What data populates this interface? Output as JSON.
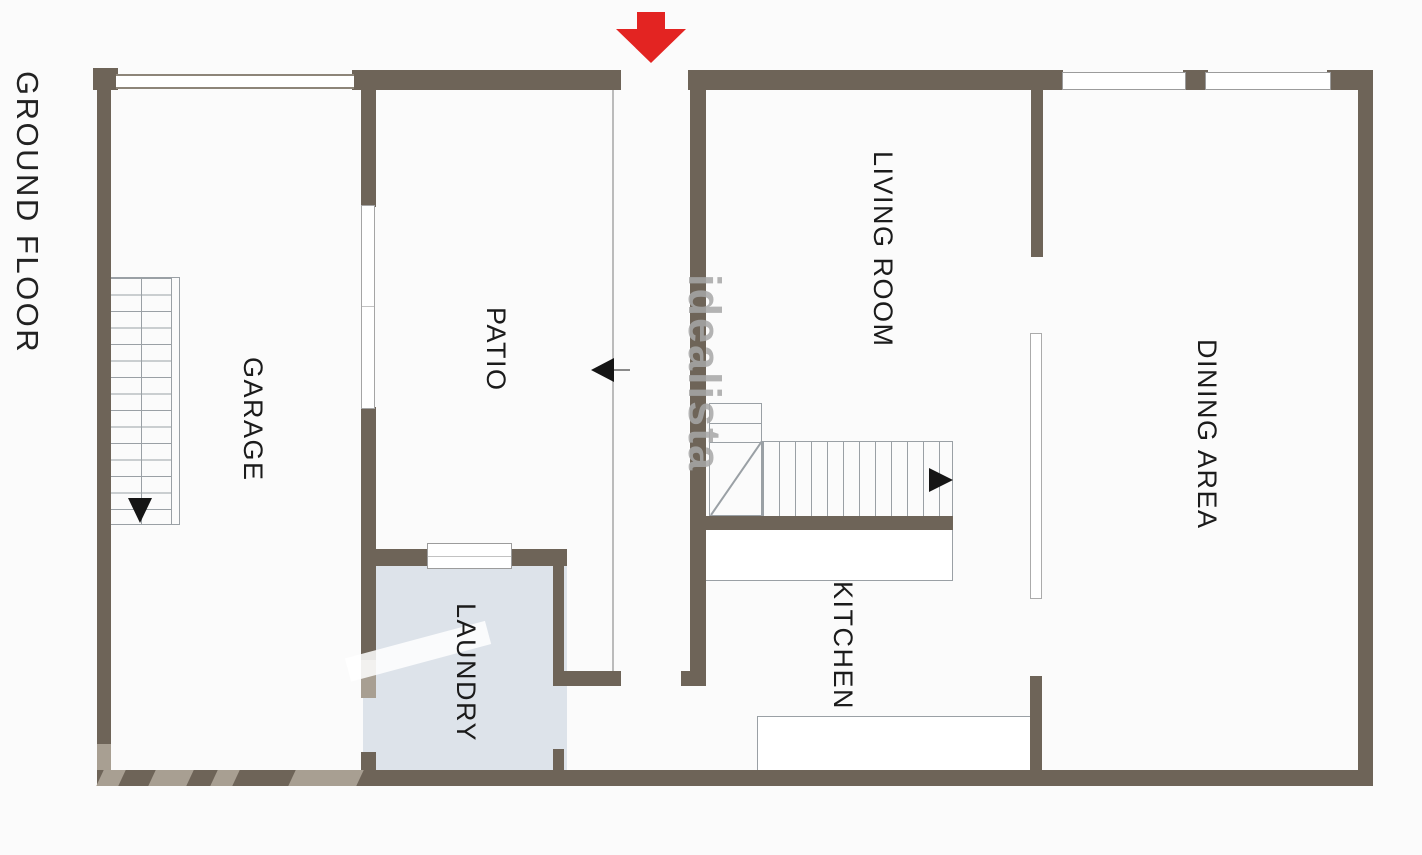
{
  "plan": {
    "title": "GROUND FLOOR",
    "watermark": "idealista",
    "rooms": {
      "garage": "GARAGE",
      "patio": "PATIO",
      "living_room": "LIVING ROOM",
      "dining_area": "DINING AREA",
      "kitchen": "KITCHEN",
      "laundry": "LAUNDRY"
    }
  },
  "colors": {
    "wall": "#6e6458",
    "wall-light": "#a89f92",
    "laundry-floor": "#dde3ea",
    "line": "#9aa0a5",
    "arrow-red": "#e32422",
    "label": "#1b1b1b",
    "watermark": "#a7a7a7",
    "bg": "#fbfbfb"
  }
}
